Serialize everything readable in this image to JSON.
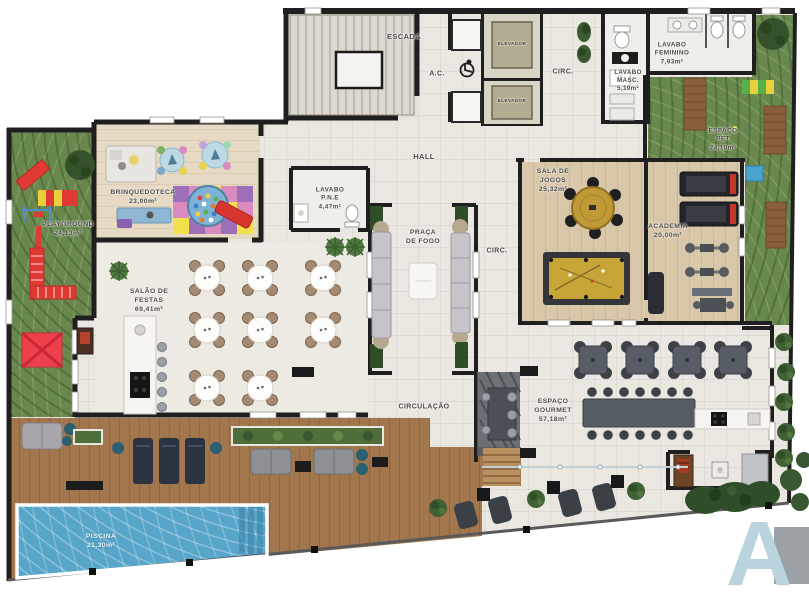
{
  "title": "Planta baixa - pavimento de lazer",
  "labels": {
    "escada": "ESCADA",
    "ac": "A.C.",
    "elevador_1": "ELEVADOR",
    "elevador_2": "ELEVADOR",
    "circ_top": "CIRC.",
    "lavabo_masc": "LAVABO\nMASC.\n5,19m²",
    "lavabo_feminino": "LAVABO\nFEMININO\n7,93m²",
    "espaco_pet": "ESPAÇO\nPET\n24,10m²",
    "hall": "HALL",
    "brinquedoteca": "BRINQUEDOTECA\n23,00m²",
    "playground": "PLAYGROUND\n24,13m²",
    "lavabo_pne": "LAVABO\nP.N.E\n4,47m²",
    "praca_de_fogo": "PRAÇA\nDE FOGO",
    "circ_mid": "CIRC.",
    "sala_de_jogos": "SALA DE\nJOGOS\n25,32m²",
    "academia": "ACADEMIA\n20,00m²",
    "salao_de_festas": "SALÃO DE\nFESTAS\n69,41m²",
    "circulacao": "CIRCULAÇÃO",
    "espaco_gourmet": "ESPAÇO\nGOURMET\n57,18m²",
    "piscina": "PISCINA\n21,30m²"
  },
  "logo": {
    "letter": "A"
  },
  "icons": {
    "accessibility": "wheelchair-icon"
  },
  "colors": {
    "wall": "#1f1f1f",
    "floor": "#eae7e1",
    "grass": "#69884e",
    "wood_deck": "#a3774e",
    "pool": "#57a5c9",
    "accent_red": "#e03a34",
    "accent_gold": "#c09a36",
    "logo_blue": "#b9d4dc"
  }
}
